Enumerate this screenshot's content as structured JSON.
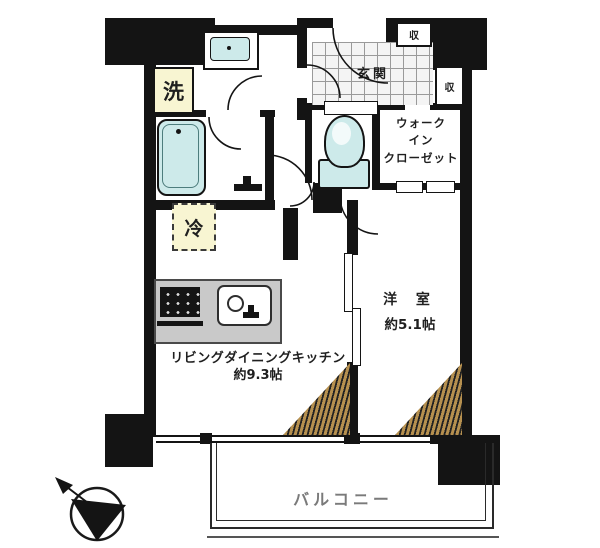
{
  "floorplan": {
    "type": "apartment-floor-plan",
    "rooms": {
      "entrance": {
        "label": "玄関"
      },
      "walk_in_closet": {
        "label": "ウォーク\nイン\nクローゼット"
      },
      "western_room": {
        "label": "洋 室",
        "size": "約5.1帖"
      },
      "ldk": {
        "label": "リビングダイニングキッチン",
        "size": "約9.3帖"
      },
      "balcony": {
        "label": "バルコニー"
      }
    },
    "fixtures": {
      "washing_machine": {
        "label": "洗"
      },
      "refrigerator": {
        "label": "冷"
      },
      "storage_upper": {
        "label": "収"
      },
      "storage_entry": {
        "label": "収"
      }
    },
    "colors": {
      "wall": "#141414",
      "water_fixture": "#cdeaea",
      "appliance_highlight": "#f8f5d2",
      "hatch": "#b6904f",
      "counter": "#c9c9c9",
      "balcony_label": "#7a7a7a"
    }
  }
}
